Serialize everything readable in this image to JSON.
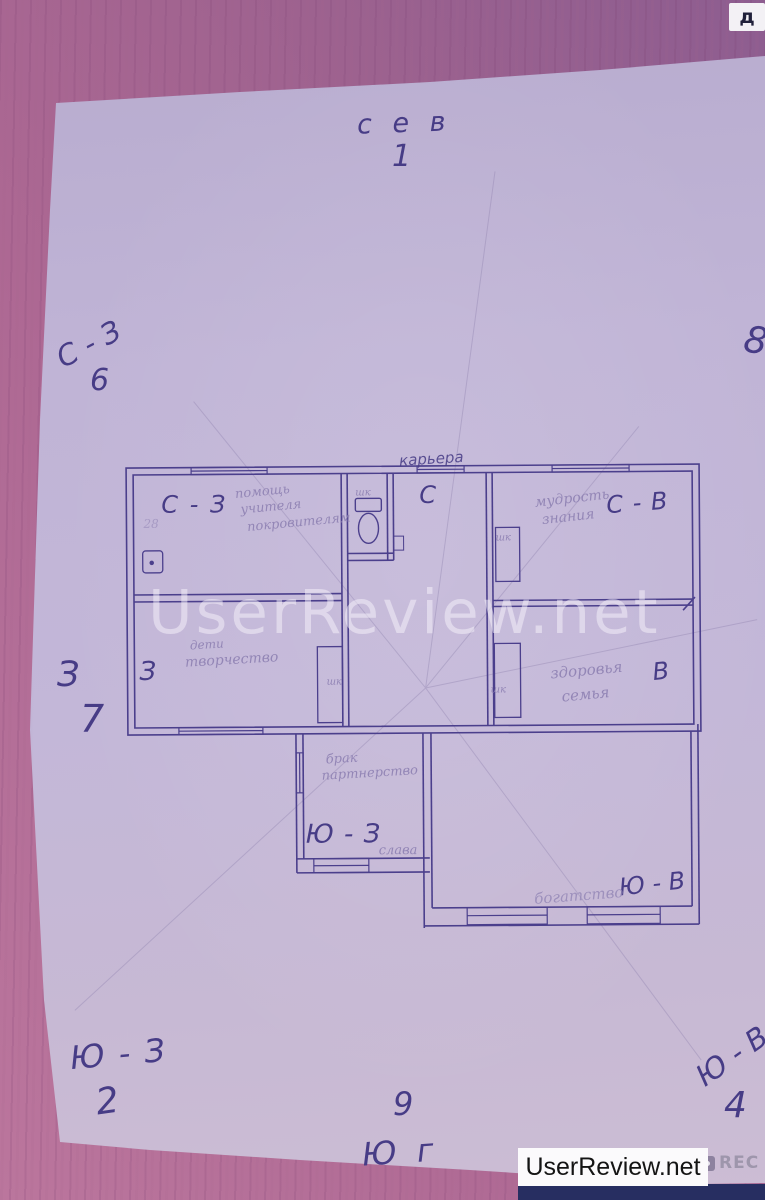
{
  "header": {
    "corner_letter": "д"
  },
  "watermark": {
    "text": "UserReview.net"
  },
  "footer": {
    "logo_text": "UserReview.net",
    "rec_label": "REC"
  },
  "compass": {
    "north_word": "с е в",
    "north_num": "1",
    "northwest_word": "С - З",
    "northwest_num": "6",
    "east_num": "8",
    "west_word": "З",
    "west_num": "7",
    "southwest_word": "Ю - З",
    "southwest_num": "2",
    "south_num": "9",
    "south_word": "Ю г",
    "southeast_word": "Ю - В",
    "southeast_num": "4"
  },
  "plan": {
    "career": "карьера",
    "north_letter": "С",
    "nw_sector": "С - З",
    "nw_line1": "помощь",
    "nw_line2": "учителя",
    "nw_line3": "покровителям",
    "nw_note": "28",
    "ne_sector": "С - В",
    "ne_line1": "мудрость",
    "ne_line2": "знания",
    "w_sector": "З",
    "w_line1": "дети",
    "w_line2": "творчество",
    "e_sector": "В",
    "e_line1": "здоровья",
    "e_line2": "семья",
    "sw_sector": "Ю - З",
    "sw_line1": "брак",
    "sw_line2": "партнерство",
    "sw_extra": "слава",
    "se_sector": "Ю - В",
    "se_line1": "богатство",
    "closet1": "шк",
    "closet2": "шк",
    "closet3": "шк",
    "closet4": "шк"
  },
  "colors": {
    "ink": "#473c86",
    "pencil": "#9386b6",
    "paper": "#c0b4d6",
    "table": "#ad6893",
    "navy_bar": "#272e61"
  }
}
